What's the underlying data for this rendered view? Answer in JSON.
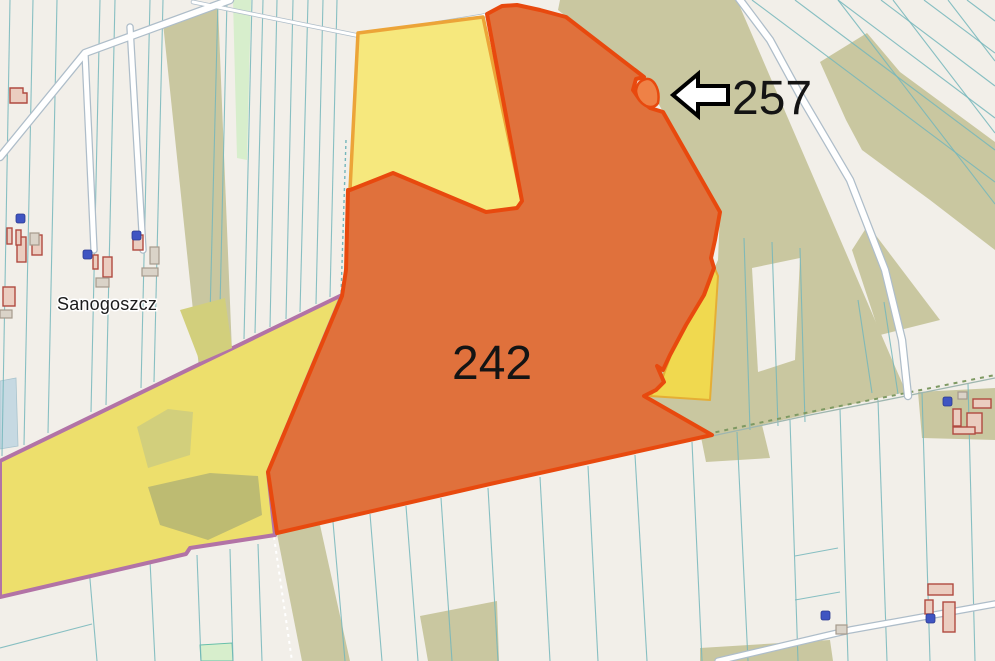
{
  "map": {
    "place_label": "Sanogoszcz",
    "parcels": {
      "parcel_242_label": "242",
      "parcel_257_label": "257"
    },
    "colors": {
      "background": "#F2EFE9",
      "forest": "#C9C7A0",
      "light_green": "#D7EECC",
      "water": "#C6D9E2",
      "parcel_line": "#74B6BB",
      "road_fill": "#FFFFFF",
      "road_casing": "#AEBDC9",
      "orange_fill": "#E0713C",
      "orange_border": "#E8490E",
      "yellow_fill": "#F6E87D",
      "yellow_border": "#ECA438",
      "notch_yellow_fill": "#F0D94F",
      "left_yellow_fill": "#EDDF6C",
      "purple_border": "#B273A6",
      "building_fill": "#EBCDC0",
      "building_stroke": "#B04A40",
      "node_blue": "#4055C2",
      "label_color": "#141414"
    }
  }
}
